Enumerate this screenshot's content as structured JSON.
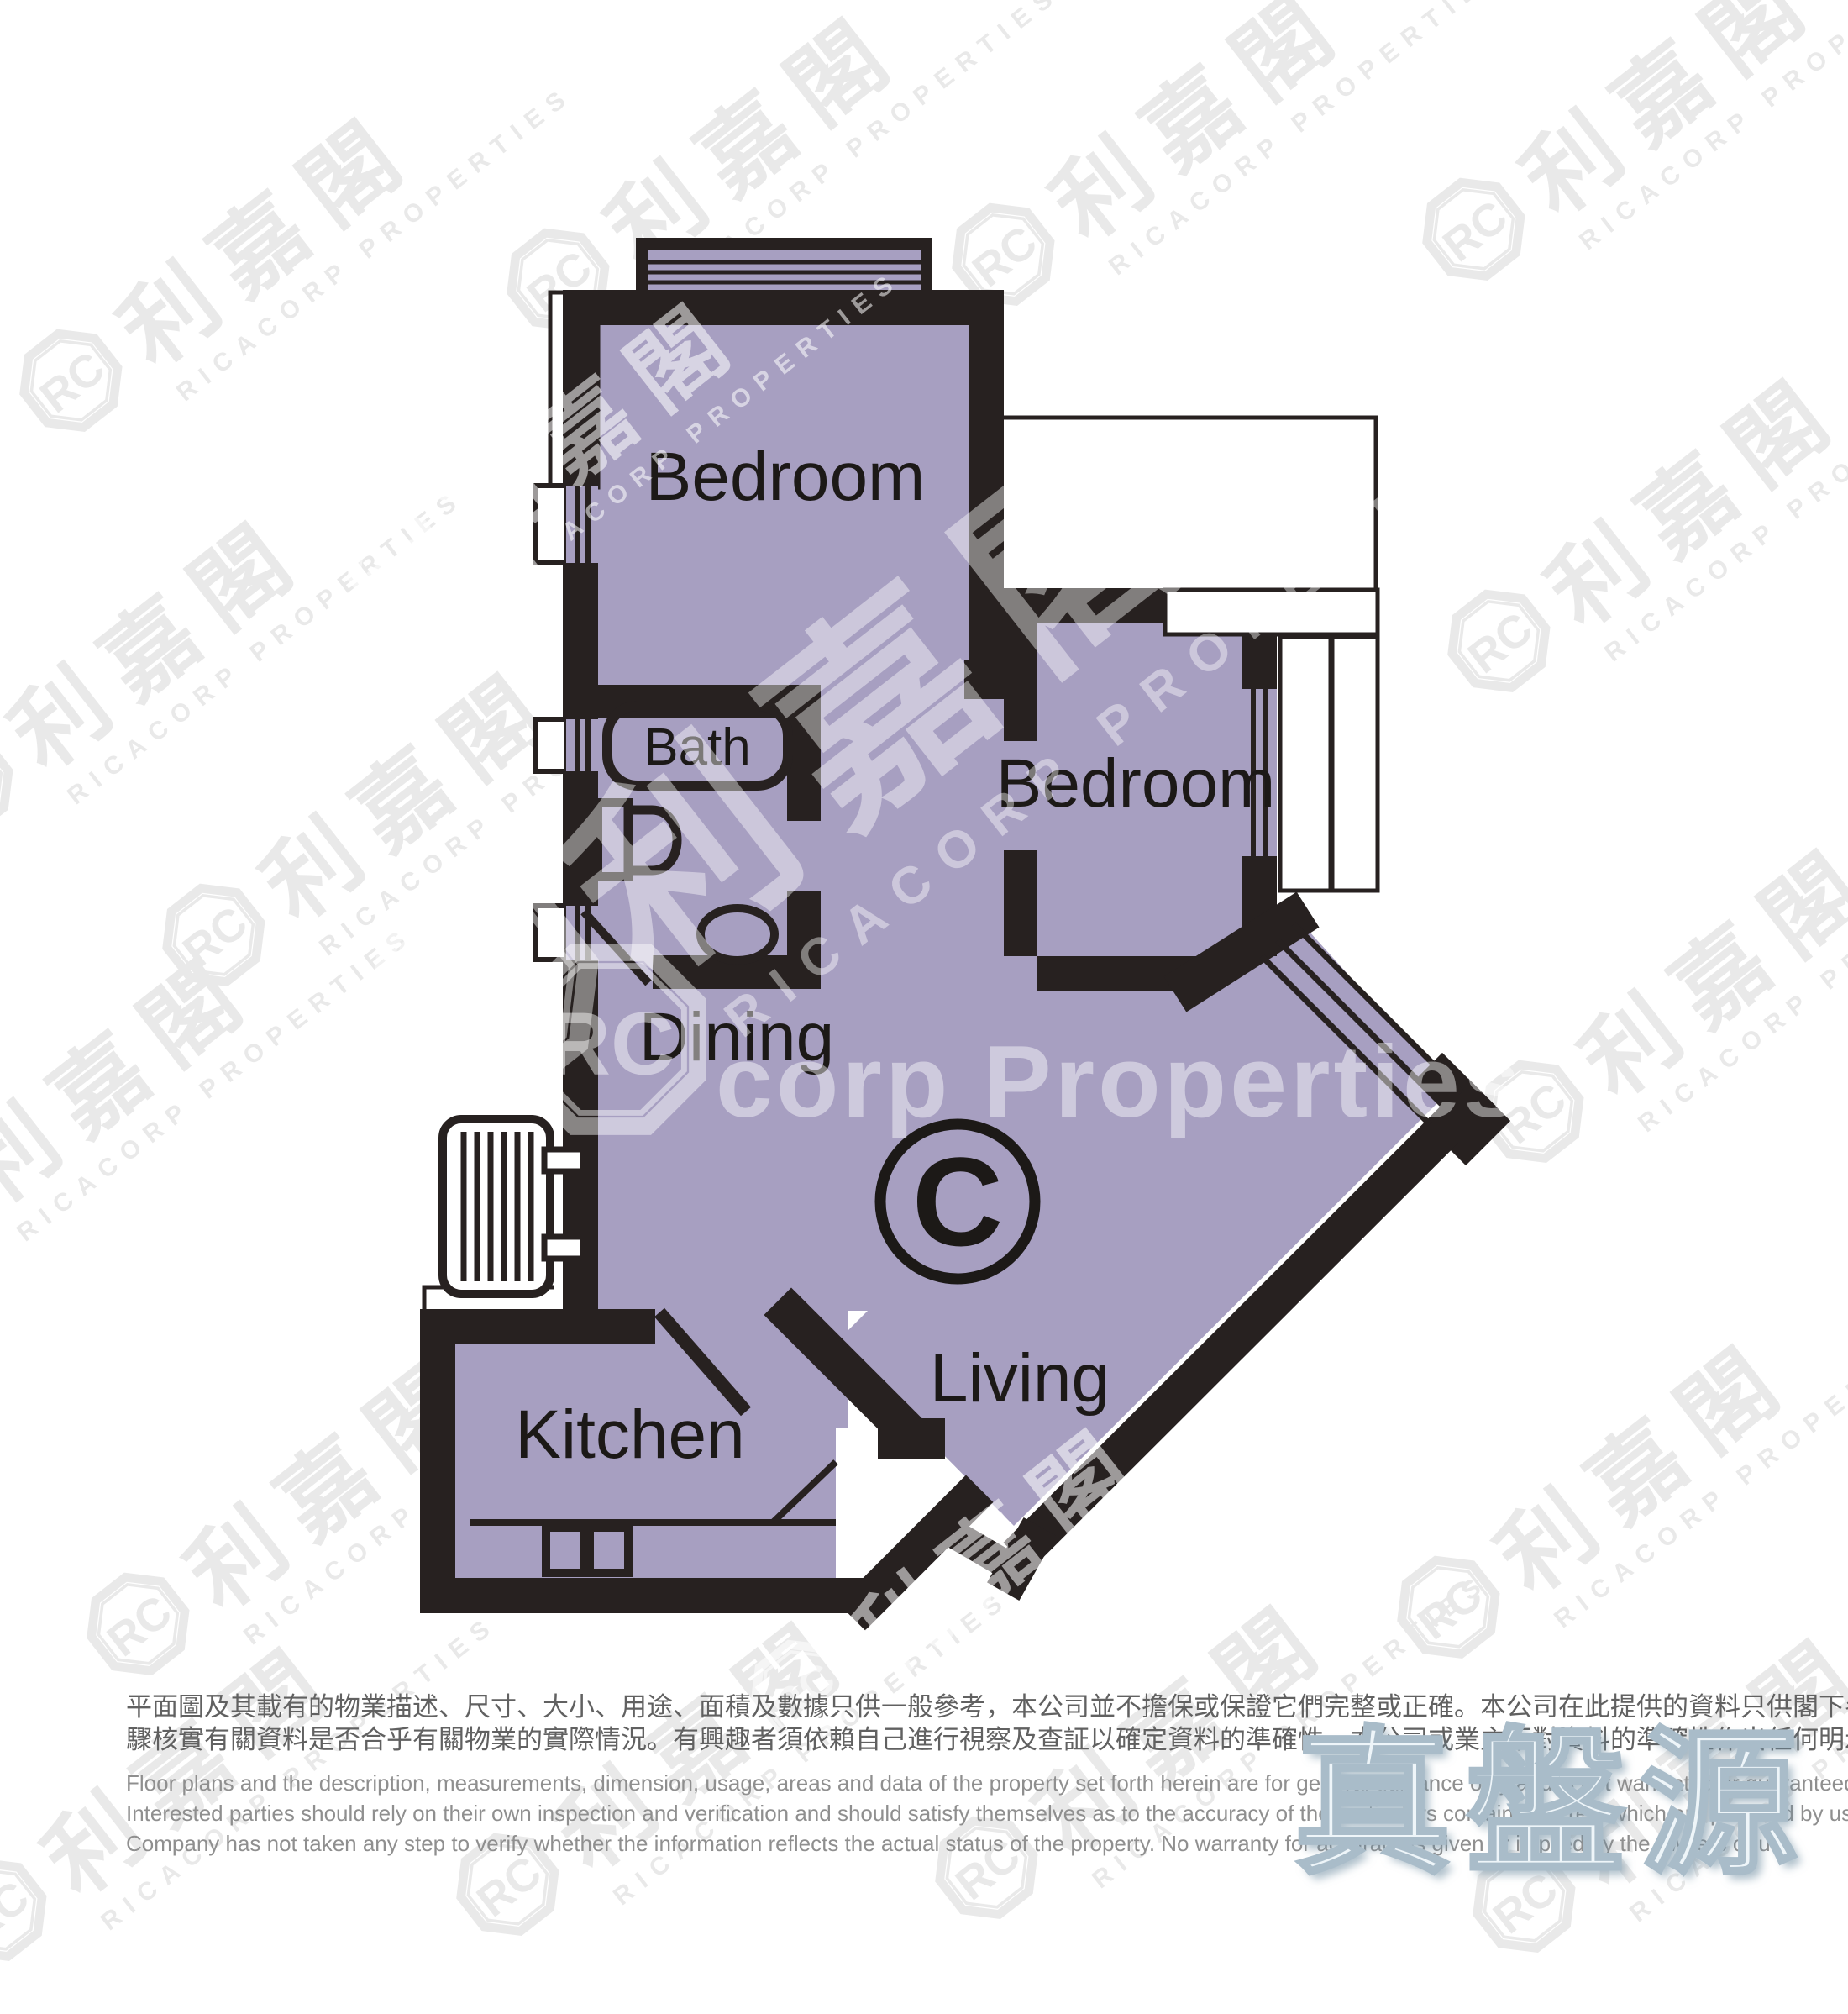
{
  "floorplan": {
    "unit_label": "C",
    "colors": {
      "fill": "#a79fc1",
      "wall": "#272120"
    },
    "labels": {
      "bedroom_top": "Bedroom",
      "bedroom_right": "Bedroom",
      "bath": "Bath",
      "dining": "Dining",
      "kitchen": "Kitchen",
      "living": "Living"
    }
  },
  "watermark": {
    "chars": "利嘉閣",
    "logo_initials": "RC",
    "company": "RICACORP PROPERTIES",
    "center_horizontal": "corp Properties"
  },
  "disclaimer": {
    "zh_line1": "平面圖及其載有的物業描述、尺寸、大小、用途、面積及數據只供一般參考，本公司並不擔保或保證它們完整或正確。本公司在此提供的資料只供閣下參考，本公司並無採取任何步",
    "zh_line2": "驟核實有關資料是否合乎有關物業的實際情況。有興趣者須依賴自己進行視察及查証以確定資料的準確性。本公司或業主不對資料的準確性作出任何明示或隱含的保證。",
    "en_line1": "Floor plans and the description, measurements, dimension, usage, areas and data of the property set forth herein are for general guidance only and is not warranted or guaranteed to be complete or correct.",
    "en_line2": "Interested parties should rely on their own inspection and verification and should satisfy themselves as to the accuracy of the particulars contained herein which are provided by us for information only.  Our",
    "en_line3": "Company has not taken any step to verify whether the information reflects the actual status of the property.  No warranty for accuracy is given or implied by the owners or us."
  },
  "verified_logo": {
    "text": "真盤源"
  }
}
